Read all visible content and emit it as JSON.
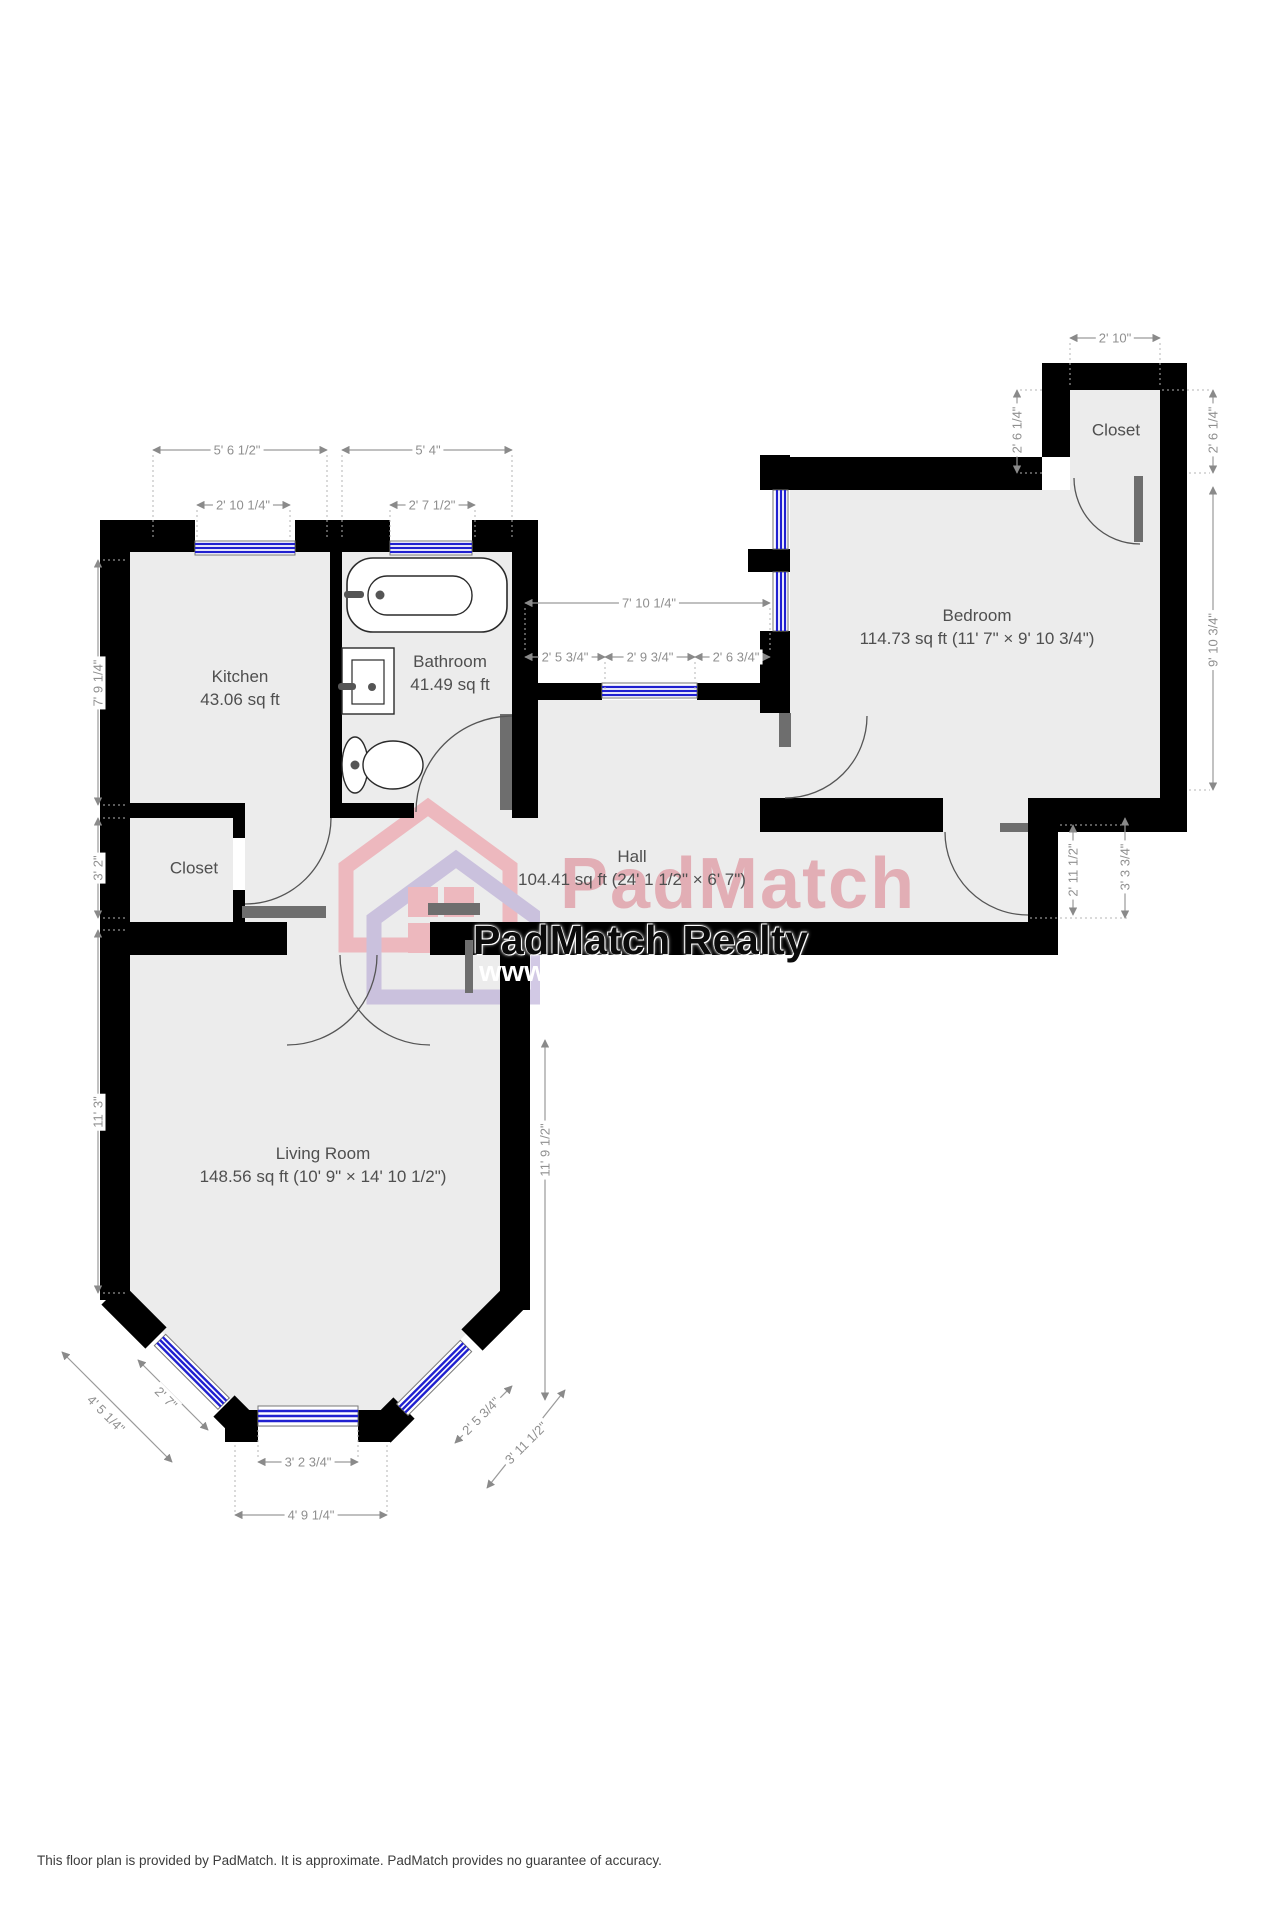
{
  "rooms": {
    "kitchen": {
      "name": "Kitchen",
      "area": "43.06 sq ft"
    },
    "bathroom": {
      "name": "Bathroom",
      "area": "41.49 sq ft"
    },
    "closet_left": {
      "name": "Closet"
    },
    "closet_tr": {
      "name": "Closet"
    },
    "hall": {
      "name": "Hall",
      "area": "104.41 sq ft (24' 1 1/2\" × 6' 7\")"
    },
    "bedroom": {
      "name": "Bedroom",
      "area": "114.73 sq ft (11' 7\" × 9' 10 3/4\")"
    },
    "living": {
      "name": "Living Room",
      "area": "148.56 sq ft (10' 9\" × 14' 10 1/2\")"
    }
  },
  "dims": [
    "5' 6 1/2\"",
    "5' 4\"",
    "2' 10 1/4\"",
    "2' 7 1/2\"",
    "7' 10 1/4\"",
    "2' 5 3/4\"",
    "2' 9 3/4\"",
    "2' 6 3/4\"",
    "2' 10\"",
    "3' 2 3/4\"",
    "4' 9 1/4\"",
    "7' 9 1/4\"",
    "3' 2\"",
    "11' 3\"",
    "11' 9 1/2\"",
    "2' 6 1/4\"",
    "2' 6 1/4\"",
    "9' 10 3/4\"",
    "2' 11 1/2\"",
    "3' 3 3/4\"",
    "4' 5 1/4\"",
    "2' 7\"",
    "2' 5 3/4\"",
    "3' 11 1/2\""
  ],
  "watermark": {
    "brand": "PadMatch",
    "realty": "PadMatch Realty",
    "url": "www.",
    "pink": "#ee96a0",
    "purple": "#b5a6d4"
  },
  "disclaimer": "This floor plan is provided by PadMatch. It is approximate. PadMatch provides no guarantee of accuracy."
}
